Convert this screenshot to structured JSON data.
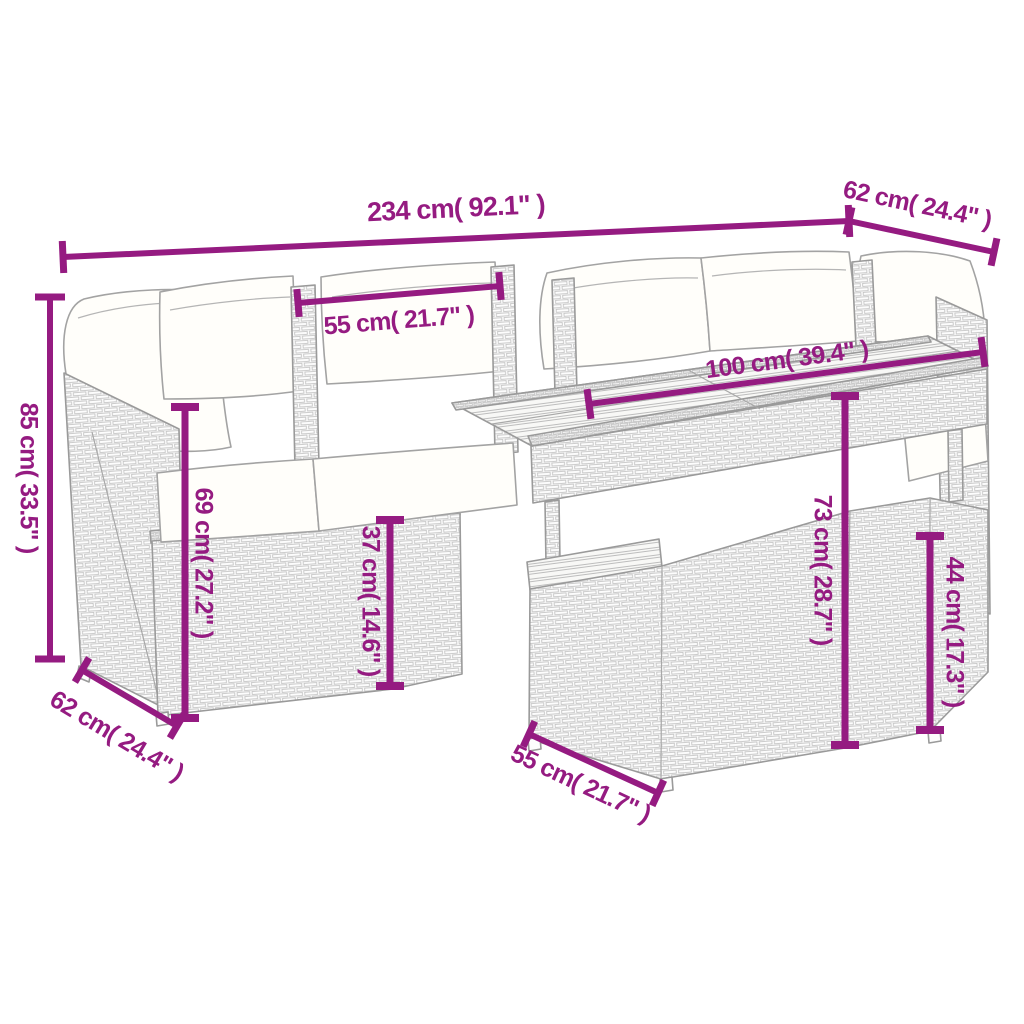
{
  "diagram": {
    "type": "product-dimension-diagram",
    "subject": "rattan garden lounge set with sofa, corner sections, dining table and ottoman",
    "background_color": "#ffffff",
    "accent_color": "#951b81",
    "line_art_color": "#9a9a9a",
    "dimensions": [
      {
        "id": "overall-width",
        "label": "234 cm( 92.1\" )",
        "x1": 63,
        "y1": 257,
        "x2": 849,
        "y2": 221,
        "w": 6,
        "cap": 32,
        "lx": 456,
        "ly": 210,
        "rot": -2.7,
        "fs": 27
      },
      {
        "id": "arm-depth-top",
        "label": "62 cm( 24.4\" )",
        "x1": 849,
        "y1": 221,
        "x2": 994,
        "y2": 252,
        "w": 6,
        "cap": 28,
        "lx": 917,
        "ly": 206,
        "rot": 12,
        "fs": 25
      },
      {
        "id": "backrest-width",
        "label": "55 cm( 21.7\" )",
        "x1": 298,
        "y1": 303,
        "x2": 500,
        "y2": 286,
        "w": 6,
        "cap": 28,
        "lx": 399,
        "ly": 322,
        "rot": -4.5,
        "fs": 25
      },
      {
        "id": "tabletop-length",
        "label": "100 cm( 39.4\" )",
        "x1": 589,
        "y1": 404,
        "x2": 983,
        "y2": 352,
        "w": 6,
        "cap": 30,
        "lx": 787,
        "ly": 361,
        "rot": -7.5,
        "fs": 25
      },
      {
        "id": "overall-height",
        "label": "85 cm( 33.5\" )",
        "x1": 50,
        "y1": 297,
        "x2": 50,
        "y2": 659,
        "w": 6,
        "cap": 30,
        "lx": 27,
        "ly": 478,
        "rot": 90,
        "fs": 25
      },
      {
        "id": "backrest-height",
        "label": "69 cm( 27.2\" )",
        "x1": 185,
        "y1": 407,
        "x2": 185,
        "y2": 718,
        "w": 7,
        "cap": 28,
        "lx": 202,
        "ly": 563,
        "rot": 90,
        "fs": 25
      },
      {
        "id": "seat-height",
        "label": "37 cm( 14.6\" )",
        "x1": 390,
        "y1": 520,
        "x2": 390,
        "y2": 686,
        "w": 7,
        "cap": 28,
        "lx": 369,
        "ly": 601,
        "rot": 90,
        "fs": 25
      },
      {
        "id": "table-height",
        "label": "73 cm( 28.7\" )",
        "x1": 845,
        "y1": 396,
        "x2": 845,
        "y2": 745,
        "w": 7,
        "cap": 28,
        "lx": 821,
        "ly": 570,
        "rot": 90,
        "fs": 25
      },
      {
        "id": "side-seat-height",
        "label": "44 cm( 17.3\" )",
        "x1": 930,
        "y1": 536,
        "x2": 930,
        "y2": 730,
        "w": 7,
        "cap": 28,
        "lx": 953,
        "ly": 632,
        "rot": 90,
        "fs": 25
      },
      {
        "id": "side-depth-bottom",
        "label": "62 cm( 24.4\" )",
        "x1": 82,
        "y1": 670,
        "x2": 177,
        "y2": 726,
        "w": 6,
        "cap": 28,
        "lx": 116,
        "ly": 737,
        "rot": 31,
        "fs": 25
      },
      {
        "id": "ottoman-width",
        "label": "55 cm( 21.7\" )",
        "x1": 529,
        "y1": 734,
        "x2": 658,
        "y2": 793,
        "w": 6,
        "cap": 28,
        "lx": 580,
        "ly": 785,
        "rot": 25,
        "fs": 25
      }
    ]
  }
}
